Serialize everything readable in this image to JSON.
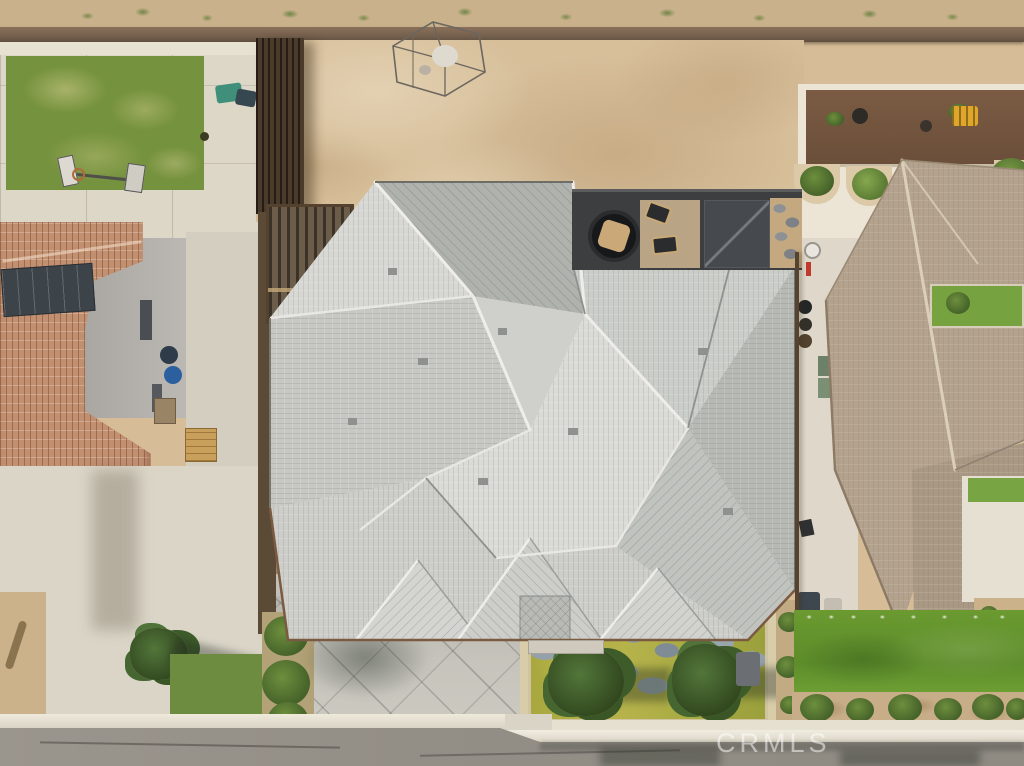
{
  "watermark": {
    "text": "CRMLS"
  },
  "palette": {
    "desert_scrub": "#c8b18b",
    "block_wall": "#7d6450",
    "dirt_lot": "#d7bf9a",
    "concrete": "#ddd7c8",
    "main_roof_tile": "#d0d0cc",
    "left_roof_tile": "#c09071",
    "right_roof_tile": "#b3a28e",
    "solar_panel": "#3c4349",
    "wood_fence": "#4a3b2b",
    "patio_pavers": "#3c3e40",
    "lawn_left": "#75923e",
    "lawn_right": "#649230",
    "courtyard_ground": "#a9a83f",
    "flagstone": "#8e9ba4",
    "driveway_score": "#bdbbb3",
    "street_asphalt": "#96918a",
    "curb": "#ece8db",
    "fire_pit_ring": "#17181a",
    "accent_teal_chair": "#3f8f7a",
    "accent_blue_bin": "#2b5f9e",
    "accent_yellow_equipment": "#e0a62a",
    "accent_red_marker": "#c0392b"
  }
}
